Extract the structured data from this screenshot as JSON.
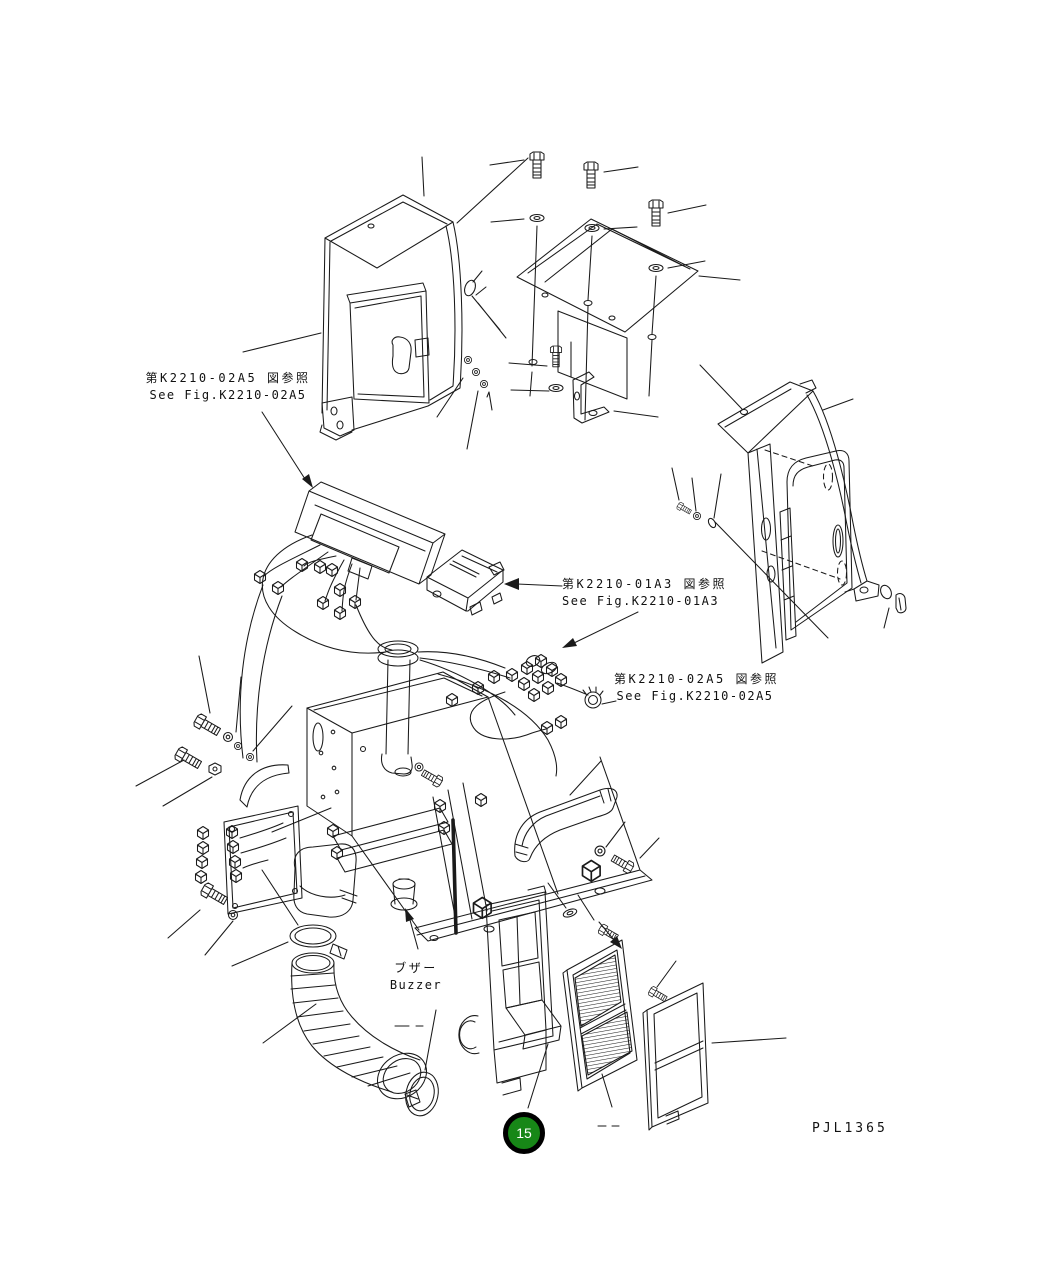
{
  "drawing": {
    "code": "PJL1365",
    "background": "#ffffff",
    "line_color": "#1a1a1a"
  },
  "labels": {
    "ref_console": {
      "jp": "第K2210-02A5 図参照",
      "en": "See Fig.K2210-02A5"
    },
    "ref_controller": {
      "jp": "第K2210-01A3 図参照",
      "en": "See Fig.K2210-01A3"
    },
    "ref_harness": {
      "jp": "第K2210-02A5 図参照",
      "en": "See Fig.K2210-02A5"
    },
    "buzzer": {
      "jp": "ブザー",
      "en": "Buzzer"
    }
  },
  "callout": {
    "number": "15",
    "fill": "#178717",
    "ring": "#000000",
    "text_color": "#ffffff"
  }
}
